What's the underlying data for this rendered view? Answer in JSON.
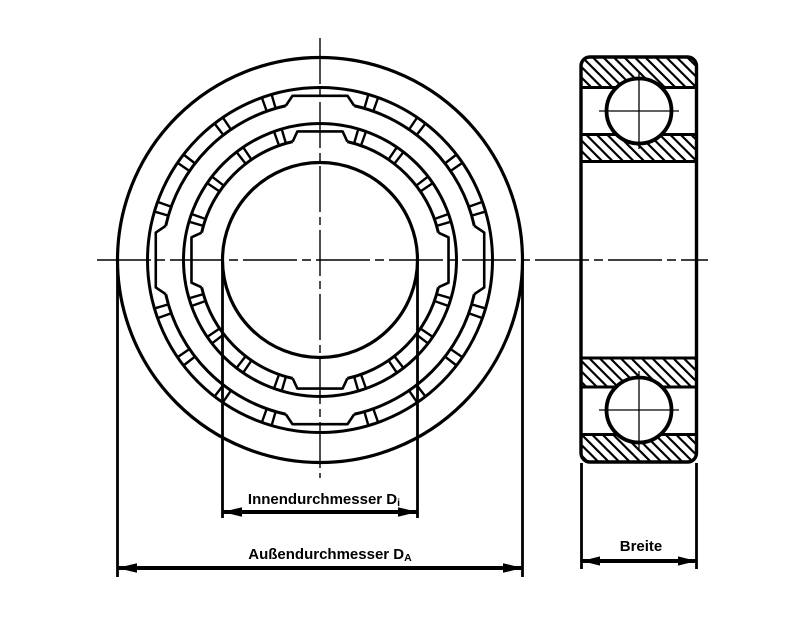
{
  "page": {
    "background": "#ffffff",
    "description": "Technical drawing of a deep-groove ball bearing: front view and sectioned side view with dimension arrows"
  },
  "labels": {
    "inner_diameter": {
      "text": "Innendurchmesser D",
      "subscript": "i"
    },
    "outer_diameter": {
      "text": "Außendurchmesser D",
      "subscript": "A"
    },
    "width": {
      "text": "Breite",
      "subscript": ""
    }
  },
  "drawing": {
    "line_color": "#000000",
    "front_view": {
      "cx": 320,
      "cy": 260,
      "outer_ring_outer_r": 202.5,
      "outer_ring_inner_r": 172.5,
      "outer_cage_r": 158,
      "inner_ring_outer_r": 136.5,
      "inner_cage_r": 121.5,
      "bore_r": 97.5,
      "pocket_angles": [
        0,
        90,
        180,
        270
      ],
      "connector_step_deg": 18,
      "connector_half_deg": 1.7,
      "outer_pocket": {
        "chord_r": 166.5,
        "chord_half_deg": 9.5,
        "base_r": 158,
        "base_half_deg": 12.5
      },
      "inner_pocket": {
        "chord_r": 130.5,
        "chord_half_deg": 10,
        "base_r": 121.5,
        "base_half_deg": 13
      }
    },
    "side_view": {
      "x": 581,
      "y": 57,
      "width": 115.5,
      "height": 405,
      "corner_radius": 9,
      "ball_cx": 639,
      "ball_r": 32.5,
      "ball_centers_y": [
        111,
        410
      ],
      "separator_ys": [
        87.5,
        134.5,
        161.5,
        358,
        387,
        434.5
      ]
    },
    "centerlines": {
      "horizontal": {
        "y": 260,
        "x1": 97,
        "x2": 708
      },
      "front_vertical": {
        "x": 320,
        "y1": 38,
        "y2": 478
      }
    },
    "dimensions": {
      "inner": {
        "x1": 222.5,
        "x2": 417.5,
        "ext_top": 260,
        "ext_bottom": 518,
        "line_y": 512,
        "label_x": 324,
        "label_y": 504
      },
      "outer": {
        "x1": 117.5,
        "x2": 522.5,
        "ext_top": 260,
        "ext_bottom": 577,
        "line_y": 568,
        "label_x": 330,
        "label_y": 559
      },
      "width": {
        "x1": 581.5,
        "x2": 696.5,
        "ext_top": 463,
        "ext_bottom": 569,
        "line_y": 561,
        "label_x": 641,
        "label_y": 551
      }
    }
  }
}
